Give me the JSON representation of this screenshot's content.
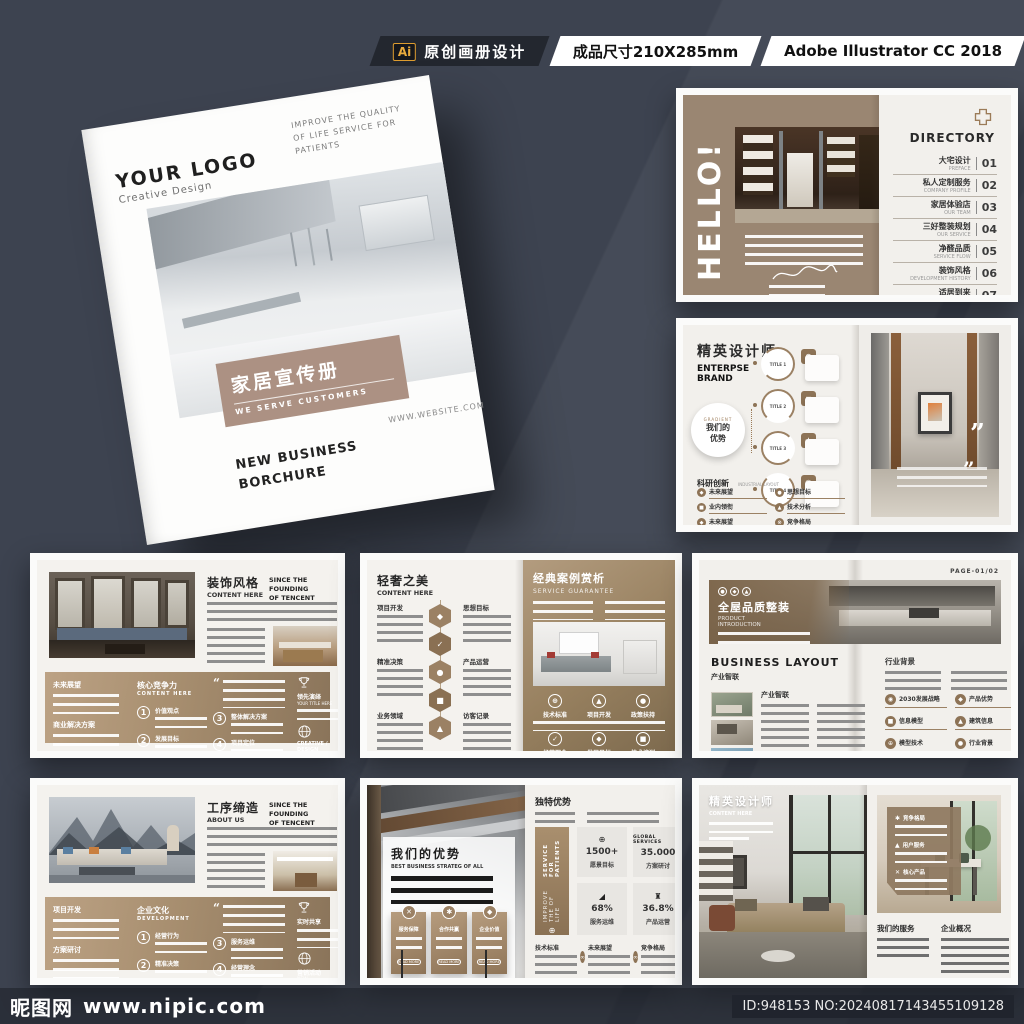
{
  "banner": {
    "ai_badge": "Ai",
    "label_design": "原创画册设计",
    "label_size": "成品尺寸210X285mm",
    "label_app": "Adobe Illustrator CC 2018"
  },
  "cover": {
    "logo": "YOUR LOGO",
    "logo_sub": "Creative Design",
    "tagline1": "IMPROVE THE QUALITY",
    "tagline2": "OF LIFE SERVICE FOR",
    "tagline3": "PATIENTS",
    "title": "家居宣传册",
    "subtitle": "WE SERVE CUSTOMERS",
    "website": "WWW.WEBSITE.COM",
    "footer1": "NEW BUSINESS",
    "footer2": "BORCHURE"
  },
  "hello": {
    "title": "HELLO!",
    "directory": "DIRECTORY",
    "items": [
      {
        "zh": "大宅设计",
        "en": "PREFACE",
        "num": "01"
      },
      {
        "zh": "私人定制服务",
        "en": "COMPANY PROFILE",
        "num": "02"
      },
      {
        "zh": "家居体验店",
        "en": "OUR TEAM",
        "num": "03"
      },
      {
        "zh": "三好整装规划",
        "en": "OUR SERVICE",
        "num": "04"
      },
      {
        "zh": "净醛品质",
        "en": "SERVICE FLOW",
        "num": "05"
      },
      {
        "zh": "装饰风格",
        "en": "DEVELOPMENT HISTORY",
        "num": "06"
      },
      {
        "zh": "适居到来",
        "en": "PRODUCT INTRODUCTION",
        "num": "07"
      }
    ]
  },
  "brand": {
    "title_zh": "精英设计师",
    "title_en1": "ENTERPSE",
    "title_en2": "BRAND",
    "hub_top": "GRADIENT",
    "hub_zh1": "我们的",
    "hub_zh2": "优势",
    "nodes": [
      "TITLE 1",
      "TITLE 2",
      "TITLE 3",
      "TITLE 4"
    ],
    "section_zh": "科研创新",
    "section_en": "INDUSTRIAL LAYOUT",
    "bullets": [
      "未来展望",
      "业内领衔",
      "未来展望",
      "思想目标",
      "技术分析",
      "竞争格局"
    ]
  },
  "deco": {
    "title_zh": "装饰风格",
    "title_en": "CONTENT HERE",
    "since1": "SINCE THE FOUNDING",
    "since2": "OF TENCENT",
    "block1": "未来展望",
    "block2": "商业解决方案",
    "core_zh": "核心竞争力",
    "core_en": "CONTENT HERE",
    "quote": "“",
    "steps": [
      {
        "n": "1",
        "t": "价值观点"
      },
      {
        "n": "2",
        "t": "发展目标"
      },
      {
        "n": "3",
        "t": "整体解决方案"
      },
      {
        "n": "4",
        "t": "项目定位"
      }
    ],
    "trophy_zh": "领先演绎",
    "trophy_en": "YOUR TITLE HERE",
    "globe1": "CREATIVE / DESIGN",
    "globe2": "NEW PRODUCTS"
  },
  "lux": {
    "title_zh": "轻奢之美",
    "title_en": "CONTENT HERE",
    "left_items": [
      "项目开发",
      "精准决策",
      "业务领域"
    ],
    "right_items": [
      "思想目标",
      "产品运营",
      "访客记录"
    ],
    "right_zh": "经典案例赏析",
    "right_en": "SERVICE GUARANTEE",
    "circles": [
      "技术标准",
      "项目开发",
      "政策扶持",
      "经营理念",
      "发展目标",
      "技术培训"
    ]
  },
  "quality": {
    "page_no": "PAGE-01/02",
    "banner_zh": "全屋品质整装",
    "banner_en1": "PRODUCT",
    "banner_en2": "INTRODUCTION",
    "section_en": "BUSINESS LAYOUT",
    "section_zh": "产业智联",
    "block_title": "产业智联",
    "right_title": "行业背景",
    "bullets": [
      "2030发展战略",
      "信息模型",
      "模型技术",
      "产品优势",
      "建筑信息",
      "行业背景"
    ]
  },
  "process": {
    "title_zh": "工序缔造",
    "title_en": "ABOUT US",
    "since1": "SINCE THE FOUNDING",
    "since2": "OF TENCENT",
    "block1": "项目开发",
    "block2": "方案研讨",
    "core_zh": "企业文化",
    "core_en": "DEVELOPMENT",
    "quote": "“",
    "steps": [
      {
        "n": "1",
        "t": "经营行为"
      },
      {
        "n": "2",
        "t": "精准决策"
      },
      {
        "n": "3",
        "t": "服务运维"
      },
      {
        "n": "4",
        "t": "经营理念"
      }
    ],
    "trophy_zh": "实时共享",
    "globe1": "营销活动",
    "globe2": "NEW PRODUCTS"
  },
  "advantage": {
    "panel_zh": "我们的优势",
    "panel_en": "BEST BUSINESS STRATEG OF ALL",
    "cards": [
      "服务保障",
      "合作共赢",
      "企业价值"
    ],
    "card_btn": "READ MORE",
    "right_title": "独特优势",
    "ribbon1": "SERVICE FOR PATIENTS",
    "ribbon2": "IMPROVE THE OF LIFE",
    "stat_top": "GLOBAL SERVICES",
    "stats": [
      {
        "v": "1500+",
        "l": "愿景目标"
      },
      {
        "v": "35.000",
        "l": "方案研讨"
      },
      {
        "v": "68%",
        "l": "服务运维"
      },
      {
        "v": "36.8%",
        "l": "产品运营"
      }
    ],
    "bottom": [
      "技术标准",
      "未来展望",
      "竞争格局"
    ]
  },
  "designer": {
    "title_zh": "精英设计师",
    "title_en": "CONTENT HERE",
    "card_items": [
      "竞争格局",
      "用户服务",
      "核心产品"
    ],
    "bottom1": "我们的服务",
    "bottom2": "企业概况"
  },
  "watermark": {
    "site": "昵图网",
    "url": "www.nipic.com",
    "id_text": "ID:948153 NO:20240817143455109128"
  }
}
